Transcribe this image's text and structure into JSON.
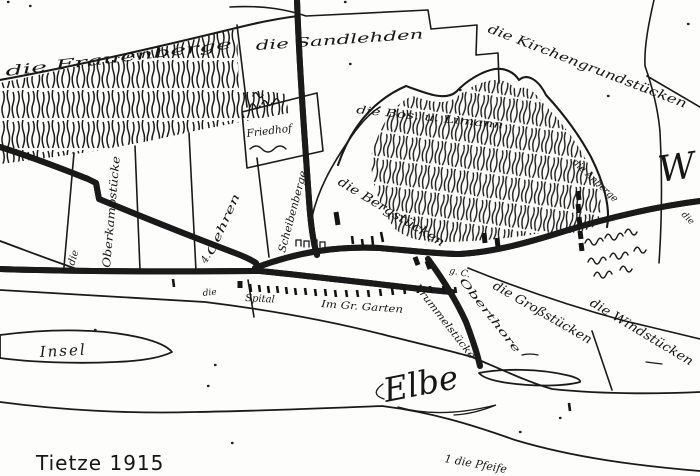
{
  "meta": {
    "ink_color": "#1a1a1a",
    "paper_color": "#fdfdfc",
    "map_type": "hand-drawn historical field map"
  },
  "labels": {
    "frauenberge": "die Frauenberge",
    "sandlehden": "die Sandlehden",
    "kirchengrundstuecken": "die Kirchengrundstücken",
    "bos_limann": "die Bos. u. Limann",
    "bergstuecken": "die Bergstücken",
    "anberge": "die Anberge",
    "die_small_left": "die",
    "oberkampstuecke": "Oberkampstücke",
    "gehren_nummer": "4.",
    "gehren": "Gehren",
    "scheibenberge": "Scheibenberge",
    "friedhof": "Friedhof",
    "spital": "Spital",
    "im_gr_garten": "Im Gr. Garten",
    "g_c": "g. C.",
    "krummelstuecke": "Krummelstücke",
    "oberthore": "Oberthore",
    "grossstuecken": "die Großstücken",
    "windstuecken": "die Windstücken",
    "die_small_right": "die",
    "w_partial": "W",
    "die_row": "die",
    "insel": "Insel",
    "elbe": "Elbe",
    "pfeife": "1 die Pfeife",
    "caption": "Tietze 1915"
  }
}
